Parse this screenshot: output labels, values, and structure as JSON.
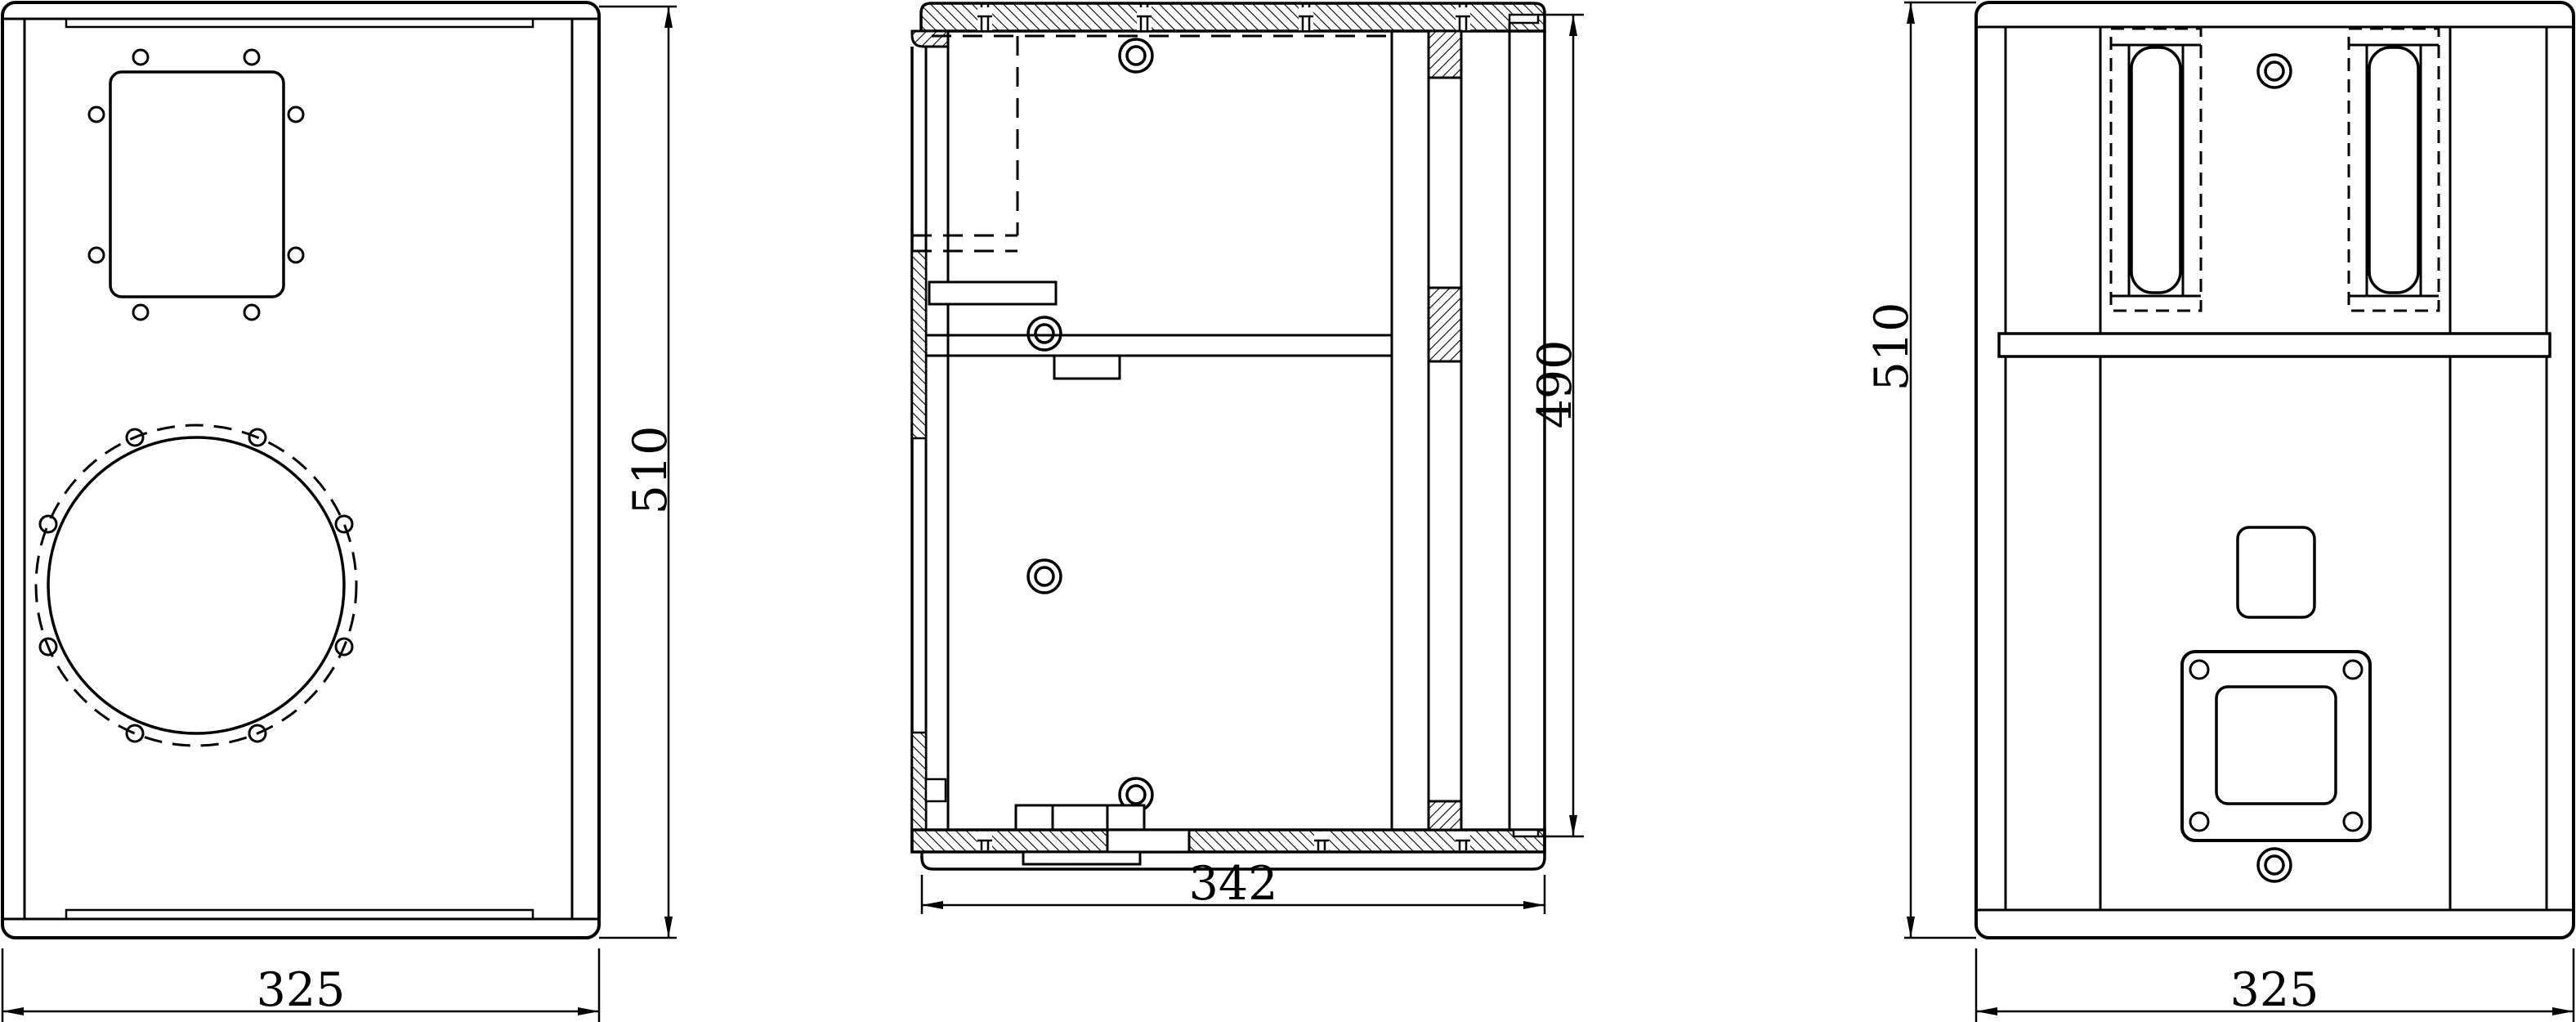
{
  "colors": {
    "line": "#000000",
    "background": "#ffffff"
  },
  "dims": {
    "front_width": "325",
    "front_height": "510",
    "side_depth": "342",
    "side_back_height": "490",
    "rear_width": "325",
    "rear_height": "510"
  }
}
